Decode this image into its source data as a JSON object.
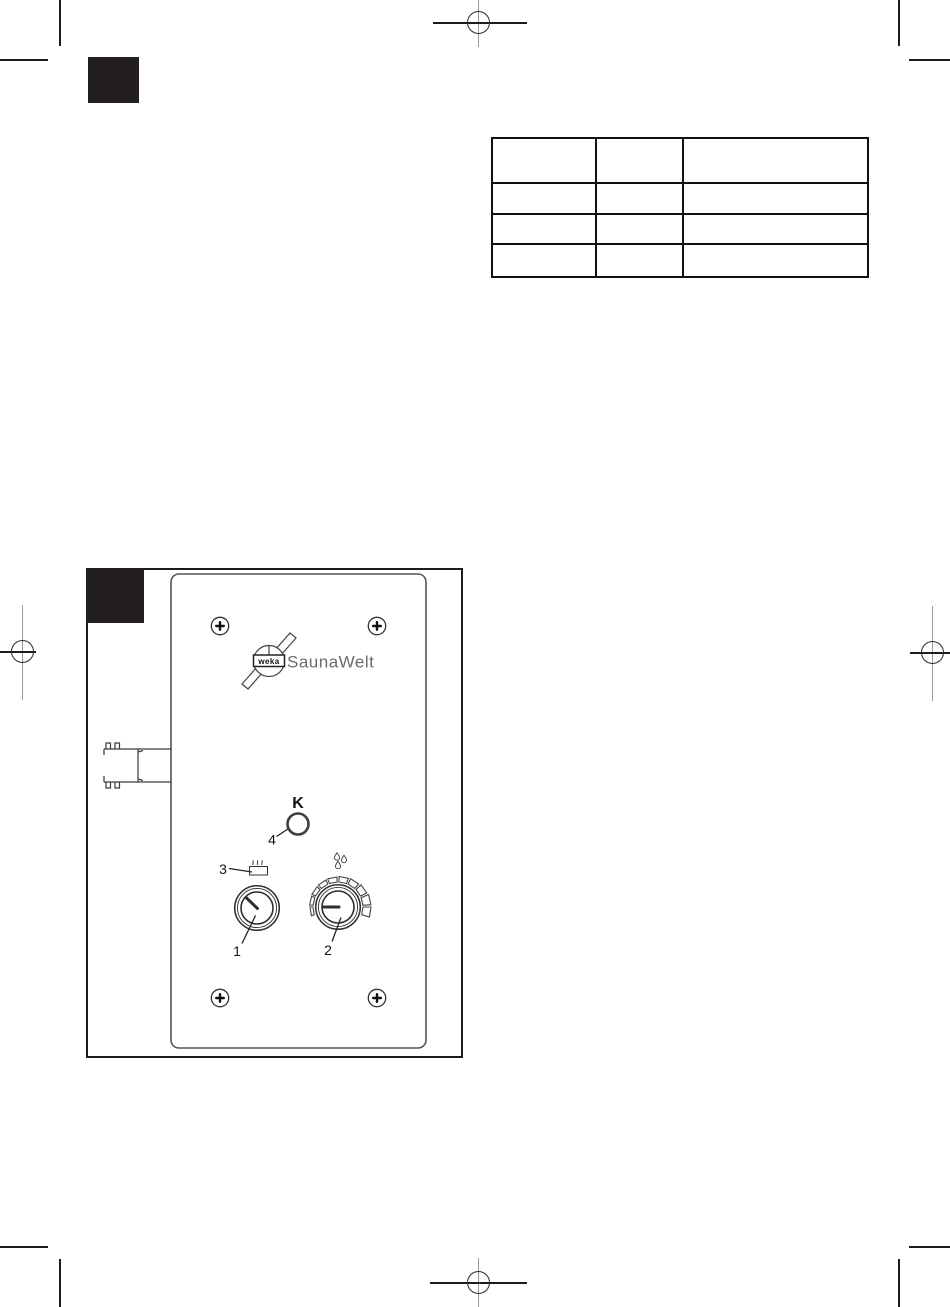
{
  "colors": {
    "ink": "#1c1c1c",
    "mark_gray": "#9a9a9a",
    "label_square": "#231f20",
    "panel_stroke": "#555555",
    "brand_gray": "#6b6b6b"
  },
  "table": {
    "columns": 3,
    "rows": 4,
    "cells": [
      [
        "",
        "",
        ""
      ],
      [
        "",
        "",
        ""
      ],
      [
        "",
        "",
        ""
      ],
      [
        "",
        "",
        ""
      ]
    ]
  },
  "figure": {
    "brand": {
      "logo_badge": "weka",
      "brand_name": "SaunaWelt"
    },
    "indicator_lamp": {
      "letter": "K"
    },
    "callouts": {
      "temperature_knob": "1",
      "humidity_knob": "2",
      "heater_icon": "3",
      "lamp": "4"
    }
  }
}
